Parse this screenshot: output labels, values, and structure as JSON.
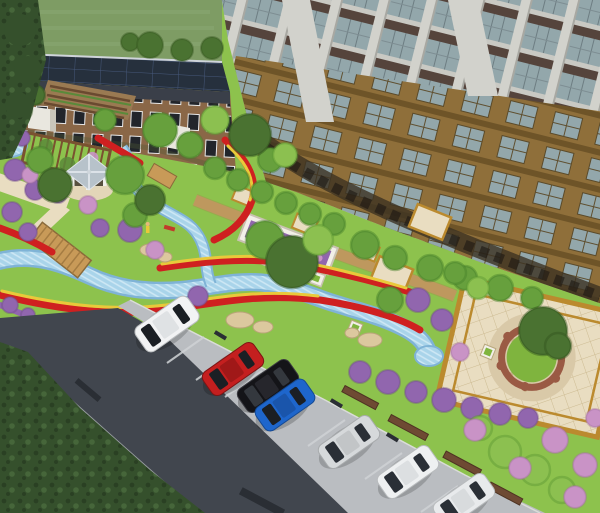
{
  "scene": {
    "type": "3d-architectural-rendering",
    "title": "Aerial rendering of residential community landscape",
    "elements": {
      "tower": "high-rise apartment tower",
      "clubhouse": "low-rise clubhouse with rooftop solar panels",
      "garden": "landscaped garden with winding stream, flower ribbons, gazebo, pergola and plazas",
      "parking": "angled roadside parking with cars",
      "road": "asphalt access road"
    }
  },
  "colors": {
    "field_green": "#7e9c64",
    "lawn_green": "#8dc24d",
    "hedge_dark": "#35502c",
    "tree_dark": "#4a7231",
    "tree_mid": "#67a03d",
    "tree_light": "#8cc050",
    "bush_purple": "#9166ae",
    "bush_pink": "#c993c6",
    "flower_red": "#cf2020",
    "flower_yellow": "#e9c93a",
    "water_blue": "#a9d4ea",
    "water_edge": "#7fb3d6",
    "path_tan": "#c9a368",
    "paving_cream": "#e9ddc1",
    "paving_gold": "#bb8a2e",
    "boardwalk_wood": "#c89a58",
    "road_asphalt": "#41464e",
    "parking_gray": "#babdc1",
    "sidewalk_gray": "#989da1",
    "curb_brown": "#6e4a33",
    "bar_dark": "#2a2e34",
    "roof_solar": "#26303d",
    "brick_facade": "#8a6747",
    "window_dark": "#22252b",
    "canopy_white": "#eef0ee",
    "tower_white": "#d2d2cc",
    "tower_glass": "#93a7ab",
    "tower_spandrel": "#55443c",
    "tower_slab": "#c9c9c3",
    "tower_brick": "#8f6f3a",
    "tower_brick_dark": "#6e5428",
    "gazebo_roof": "#b7c2ca",
    "gazebo_white": "#f0f0ec",
    "planter_white": "#f2efe8",
    "mound_green": "#7fb43e",
    "stone_tan": "#d9c9a8",
    "wall_brick": "#9a5a44",
    "soil_brown": "#9a7a52",
    "sand": "#dcc89e"
  },
  "cars": [
    {
      "name": "white-suv",
      "color": "#f2f3f4"
    },
    {
      "name": "red-sedan",
      "color": "#c41f1f"
    },
    {
      "name": "black-sedan",
      "color": "#141418"
    },
    {
      "name": "blue-hatchback",
      "color": "#1e66cc"
    },
    {
      "name": "silver-car",
      "color": "#d6d9db"
    },
    {
      "name": "white-car",
      "color": "#eef0f1"
    },
    {
      "name": "white-car-2",
      "color": "#e8eaec"
    }
  ]
}
